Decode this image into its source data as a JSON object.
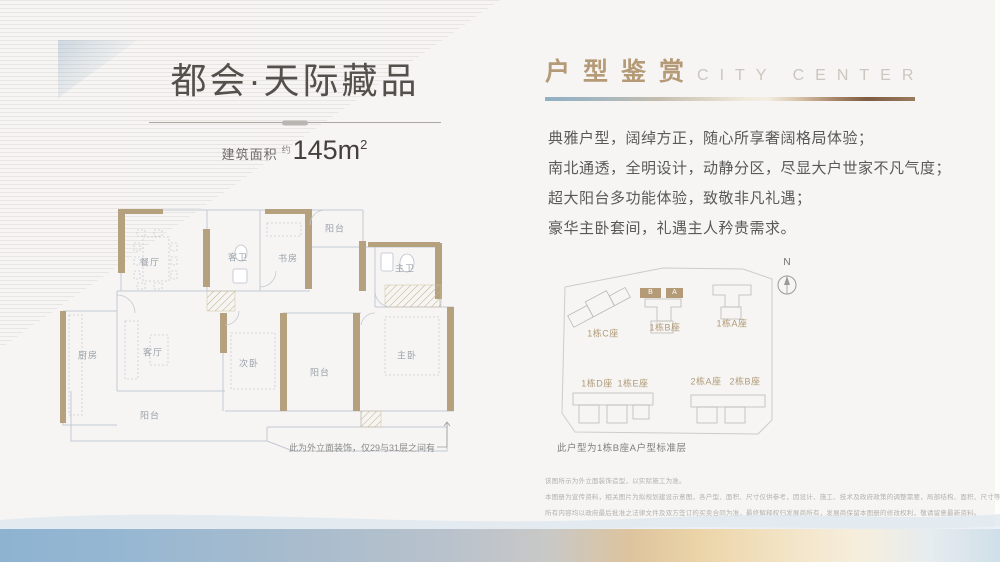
{
  "title": {
    "main": "都会·天际藏品",
    "area_label": "建筑面积",
    "area_prefix": "约",
    "area_value": "145m",
    "area_sup": "2"
  },
  "section": {
    "title_cn": "户型鉴赏",
    "title_en": "CITY CENTER"
  },
  "intro": {
    "lines": [
      "典雅户型，阔绰方正，随心所享奢阔格局体验；",
      "南北通透，全明设计，动静分区，尽显大户世家不凡气度；",
      "超大阳台多功能体验，致敬非凡礼遇；",
      "豪华主卧套间，礼遇主人矜贵需求。"
    ]
  },
  "floorplan": {
    "rooms": [
      {
        "label": "餐厅"
      },
      {
        "label": "客卫"
      },
      {
        "label": "书房"
      },
      {
        "label": "阳台"
      },
      {
        "label": "主卫"
      },
      {
        "label": "厨房"
      },
      {
        "label": "客厅"
      },
      {
        "label": "次卧"
      },
      {
        "label": "阳台"
      },
      {
        "label": "主卧"
      },
      {
        "label": "阳台"
      }
    ],
    "note": "此为外立面装饰，仅29与31层之间有"
  },
  "siteplan": {
    "north": "N",
    "unit_b": "B",
    "unit_a": "A",
    "buildings": [
      {
        "label": "1栋C座"
      },
      {
        "label": "1栋B座"
      },
      {
        "label": "1栋A座"
      },
      {
        "label": "1栋D座"
      },
      {
        "label": "1栋E座"
      },
      {
        "label": "2栋A座"
      },
      {
        "label": "2栋B座"
      }
    ],
    "caption": "此户型为1栋B座A户型标准层"
  },
  "disclaimer": {
    "lines": [
      "该图所示为外立面装饰造型，以实际施工为准。",
      "本图册为宣传资料，相关图片为拟规划建设示意图，各户型、面积、尺寸仅供参考，因设计、施工、技术及政府政策的调整需要，局部结构、面积、尺寸等可能不同，",
      "所有内容均以政府最后批准之法律文件及双方签订的买卖合同为准，最终解释权归发展商所有，发展商保留本图册的修改权利，敬请留意最新资料。"
    ]
  },
  "colors": {
    "accent_tan": "#b49a76",
    "wall_tan": "#b5a17d",
    "band_blue": "#8db3d1",
    "band_brown": "#8a6a4f"
  }
}
